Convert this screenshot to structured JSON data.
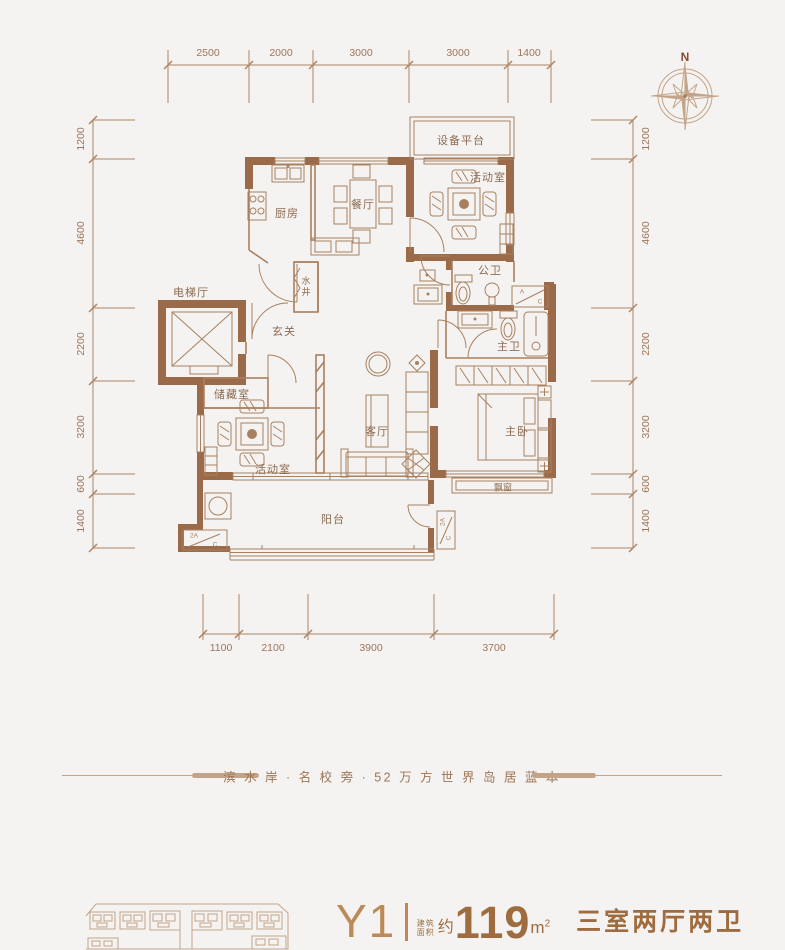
{
  "colors": {
    "bg": "#f4f3f1",
    "wall": "#9a6a49",
    "line": "#a9805f",
    "line_light": "#c3a489",
    "dim": "#ad8465",
    "dim_text": "#9f755a",
    "room_text": "#8d6b52",
    "accent": "#bb8a57",
    "title_brown": "#9e6c3f",
    "tagline": "#9d7556",
    "compass_n": "#8a4a30"
  },
  "compass": {
    "north_label": "N"
  },
  "dimensions": {
    "top": [
      "2500",
      "2000",
      "3000",
      "3000",
      "1400"
    ],
    "bottom": [
      "1100",
      "2100",
      "3900",
      "3700"
    ],
    "left": [
      "1200",
      "4600",
      "2200",
      "3200",
      "600",
      "1400"
    ],
    "right": [
      "1200",
      "4600",
      "2200",
      "3200",
      "600",
      "1400"
    ]
  },
  "rooms": {
    "equipment_platform": "设备平台",
    "activity_room_top": "活动室",
    "kitchen": "厨房",
    "dining": "餐厅",
    "public_bath": "公卫",
    "elevator_hall": "电梯厅",
    "water_shaft": "水井",
    "entry": "玄关",
    "master_bath": "主卫",
    "storage": "储藏室",
    "living": "客厅",
    "master_bedroom": "主卧",
    "activity_room_bottom": "活动室",
    "bay_window": "飘窗",
    "balcony": "阳台"
  },
  "ac": {
    "a": "A",
    "c": "C",
    "two_a": "2A"
  },
  "tagline": {
    "text": "滨 水 岸 · 名 校 旁 · 52 万 方 世 界 岛 居 蓝 本"
  },
  "unit_info": {
    "model": "Y1",
    "area_label_line1": "建筑",
    "area_label_line2": "面积",
    "approx": "约",
    "area_value": "119",
    "area_unit_base": "m",
    "area_unit_sup": "2",
    "layout": "三室两厅两卫"
  }
}
